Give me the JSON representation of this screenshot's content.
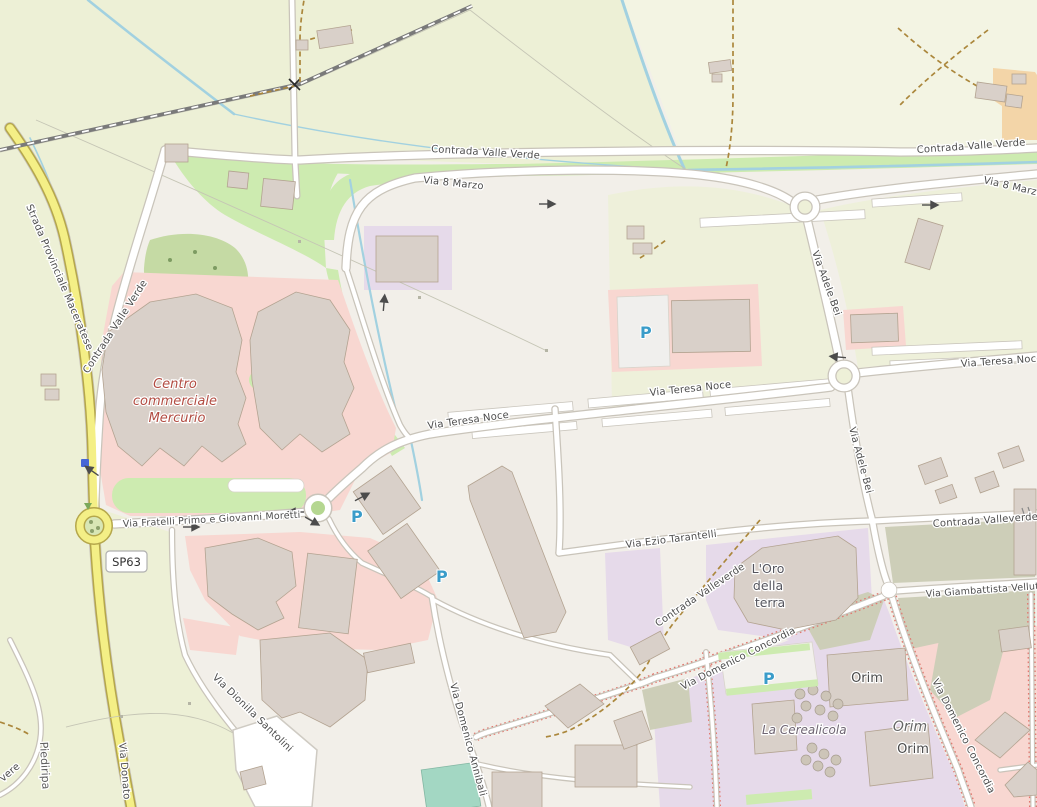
{
  "map_labels": {
    "roads": {
      "strada_provinciale_maceratese": "Strada Provinciale Maceratese",
      "contrada_valle_verde": "Contrada Valle Verde",
      "via_8_marzo": "Via 8 Marzo",
      "via_adele_bei": "Via Adele Bei",
      "via_teresa_noce": "Via Teresa Noce",
      "via_fratelli_primo_e_giovanni_moretti": "Via Fratelli Primo e Giovanni Moretti",
      "via_ezio_tarantelli": "Via Ezio Tarantelli",
      "contrada_valleverde": "Contrada Valleverde",
      "via_giambattista_velluti": "Via Giambattista Velluti",
      "via_domenico_concordia": "Via Domenico Concordia",
      "via_dionilla_santolini": "Via Dionilla Santolini",
      "via_domenico_annibali": "Via Domenico Annibali",
      "via_donato": "Via Donato",
      "road_fragment_vere": "vere",
      "ref_sp63": "SP63"
    },
    "places": {
      "piediripa": "Piediripa",
      "centro_commerciale_mercurio": [
        "Centro",
        "commerciale",
        "Mercurio"
      ],
      "loro_della_terra": [
        "L'Oro",
        "della",
        "terra"
      ],
      "orim": "Orim",
      "la_cerealicola": "La Cerealicola"
    },
    "icons": {
      "parking": "P"
    }
  },
  "colors": {
    "base_land": "#f2efe9",
    "farmland": "#edf0d6",
    "grass": "#cdebb0",
    "retail_pink": "#f8d7d1",
    "industrial_lavender": "#e6daea",
    "brownfield_olive": "#cdceb8",
    "building": "#d9d0c9",
    "secondary_road_yellow": "#f4ef86",
    "water": "#a2d1e0",
    "railway": "#7a7a7a",
    "parking_blue": "#3a9cc9",
    "road_label": "#4d4d4d",
    "retail_label_red": "#b24c42",
    "track_orange": "#ab873c"
  }
}
